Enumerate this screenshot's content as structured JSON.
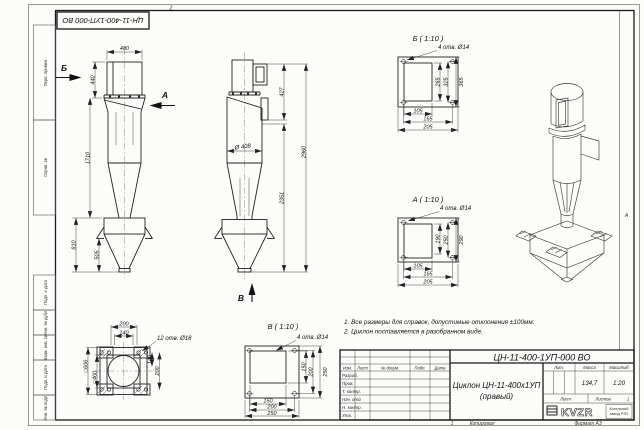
{
  "frame": {
    "stamp": "ЦН-11-400-1УП-000 ВО",
    "zone_top": "2",
    "zone_bottom": "1",
    "zone_side": "А",
    "margin_labels": [
      "Перв. примен.",
      "Справ. №",
      "Подп. и дата",
      "Инв. № дубл.",
      "Взам. инв. №",
      "Подп. и дата",
      "Инв. № подл."
    ],
    "copied": "Копировал",
    "format": "Формат А3"
  },
  "views": {
    "front": {
      "d480": "480",
      "d440": "440",
      "d1710": "1710",
      "d810": "810",
      "d505": "505",
      "marker_b": "Б",
      "marker_a": "А"
    },
    "side": {
      "d427": "427",
      "d2960": "2960",
      "d2351": "2351",
      "dia408": "Ø 408",
      "marker_v": "В"
    },
    "bottom": {
      "holes": "12 отв. Ø18",
      "d200_top": "200",
      "d140_top": "140",
      "d140_right": "140",
      "d200_right": "200",
      "sq_outer": "□606",
      "sq_inner": "□400"
    },
    "detail_b": {
      "title": "Б ( 1:10 )",
      "holes": "4 отв. Ø14",
      "v1": "265",
      "v2": "325",
      "v3": "365",
      "h1": "105",
      "h2": "165",
      "h3": "205"
    },
    "detail_a": {
      "title": "А ( 1:10 )",
      "holes": "4 отв. Ø14",
      "v1": "190",
      "v2": "250",
      "v3": "290",
      "h1": "105",
      "h2": "165",
      "h3": "205"
    },
    "detail_v": {
      "title": "В ( 1:10 )",
      "holes": "4 отв. Ø14",
      "v1": "150",
      "v2": "200",
      "v3": "250",
      "h1": "150",
      "h2": "200",
      "h3": "250"
    }
  },
  "notes": {
    "line1": "1. Все размеры для справок, допустимые отклонения ±100мм.",
    "line2": "2. Циклон поставляется в разобранном виде."
  },
  "title_block": {
    "designation": "ЦН-11-400-1УП-000 ВО",
    "name1": "Циклон ЦН-11-400х1УП",
    "name2": "(правый)",
    "col_izm": "Изм.",
    "col_list": "Лист",
    "col_doc": "№ докум.",
    "col_podp": "Подп.",
    "col_data": "Дата",
    "rows": [
      "Разраб.",
      "Пров.",
      "Т. контр.",
      "Нач. отд.",
      "Н. контр.",
      "Утв."
    ],
    "lit": "Лит.",
    "mass": "Масса",
    "scale": "Масштаб",
    "mass_value": "134,7",
    "scale_value": "1:20",
    "sheet": "Лист",
    "sheets": "Листов",
    "sheets_value": "1",
    "logo": "KVZR",
    "company1": "Котельный",
    "company2": "завод РЗП"
  }
}
